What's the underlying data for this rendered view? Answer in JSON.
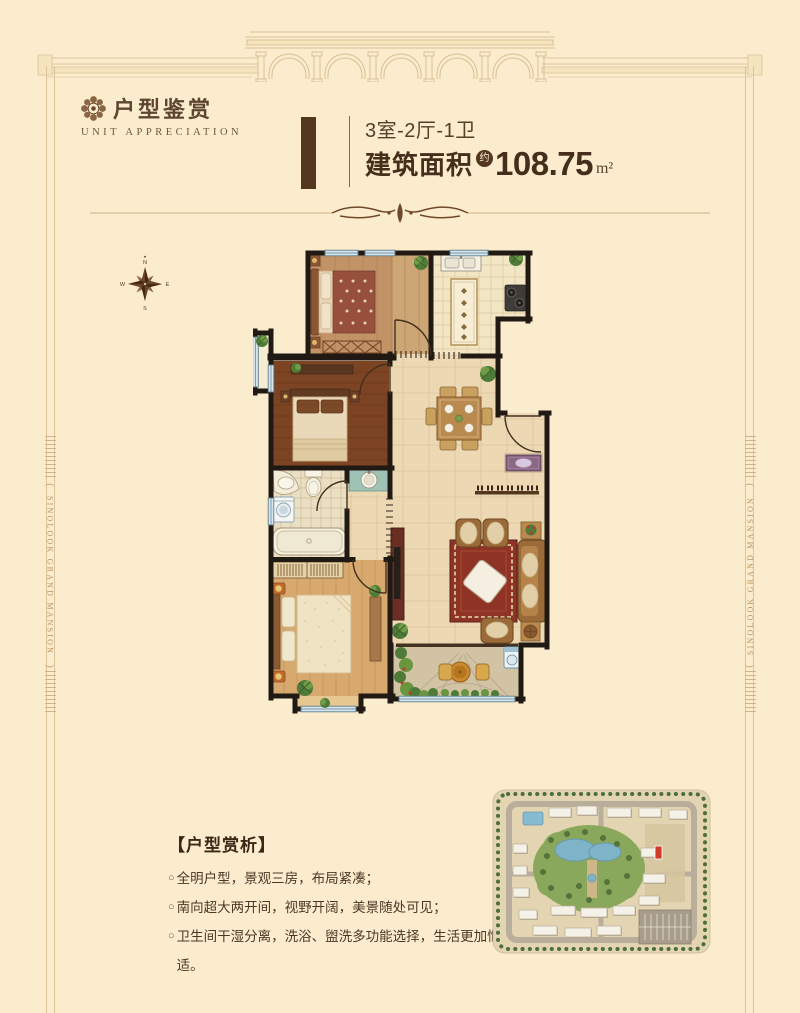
{
  "logo": {
    "icon": "rosette-seal-icon",
    "title": "户型鉴赏",
    "subtitle": "UNIT APPRECIATION"
  },
  "header": {
    "layout": "3室-2厅-1卫",
    "area_label": "建筑面积",
    "area_approx": "约",
    "area_value": "108.75",
    "area_unit": "m²"
  },
  "margins": {
    "left_text": "SINOLOOK GRAND MANSION",
    "right_text": "SINOLOOK GRAND MANSION"
  },
  "compass": {
    "north": "N",
    "east": "E",
    "south": "S",
    "west": "W"
  },
  "analysis": {
    "title": "【户型赏析】",
    "marker": "○",
    "bullets": [
      "全明户型，景观三房，布局紧凑；",
      "南向超大两开间，视野开阔，美景随处可见；",
      "卫生间干湿分离，洗浴、盥洗多功能选择，生活更加惬意舒适。"
    ]
  },
  "colors": {
    "background": "#fbeccd",
    "accent_brown": "#53371f",
    "frame_tan": "#d8bd92",
    "wall_black": "#211913",
    "window_blue": "#9fc0d4",
    "site_highlight_red": "#d23b2a"
  }
}
